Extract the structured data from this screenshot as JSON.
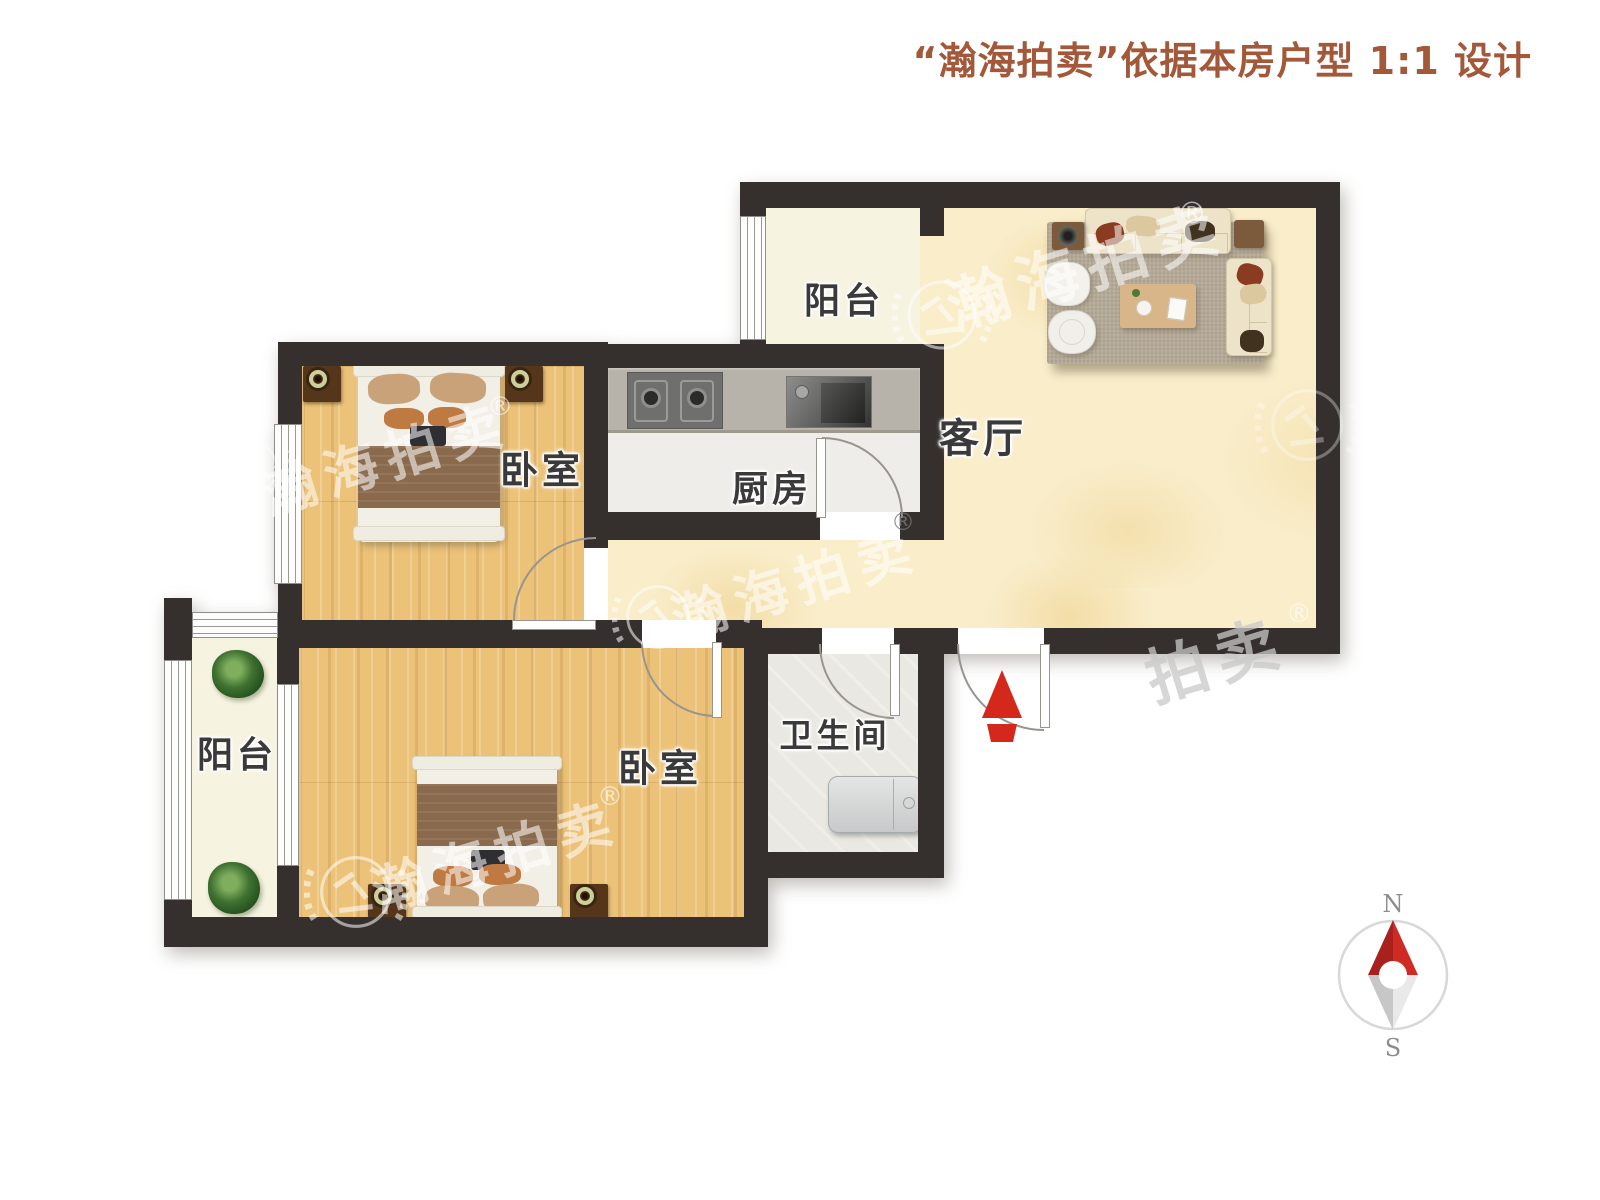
{
  "title": {
    "text": "“瀚海拍卖”依据本房户型 1:1 设计",
    "color": "#a3583a"
  },
  "rooms": {
    "living": {
      "label": "客厅"
    },
    "balcony_top": {
      "label": "阳台"
    },
    "kitchen": {
      "label": "厨房"
    },
    "bedroom_upper": {
      "label": "卧室"
    },
    "bedroom_lower": {
      "label": "卧室"
    },
    "bathroom": {
      "label": "卫生间"
    },
    "balcony_left": {
      "label": "阳台"
    }
  },
  "watermark": {
    "text": "瀚海拍卖",
    "partial_text": "拍卖",
    "registered": "®",
    "logo": "auction-gavel-laurel-emblem"
  },
  "compass": {
    "north": "N",
    "south": "S",
    "needle_north_color": "#c0251f",
    "needle_south_color": "#d9d9d9"
  },
  "palette": {
    "wall": "#35302d",
    "wood_floor": "#ecc278",
    "living_floor": "#f9edca",
    "balcony_floor": "#f6f3e1",
    "kitchen_floor": "#efedea",
    "bathroom_floor": "#eae8e2",
    "entry_arrow": "#d4281c",
    "label_text": "#3a3a3a"
  }
}
